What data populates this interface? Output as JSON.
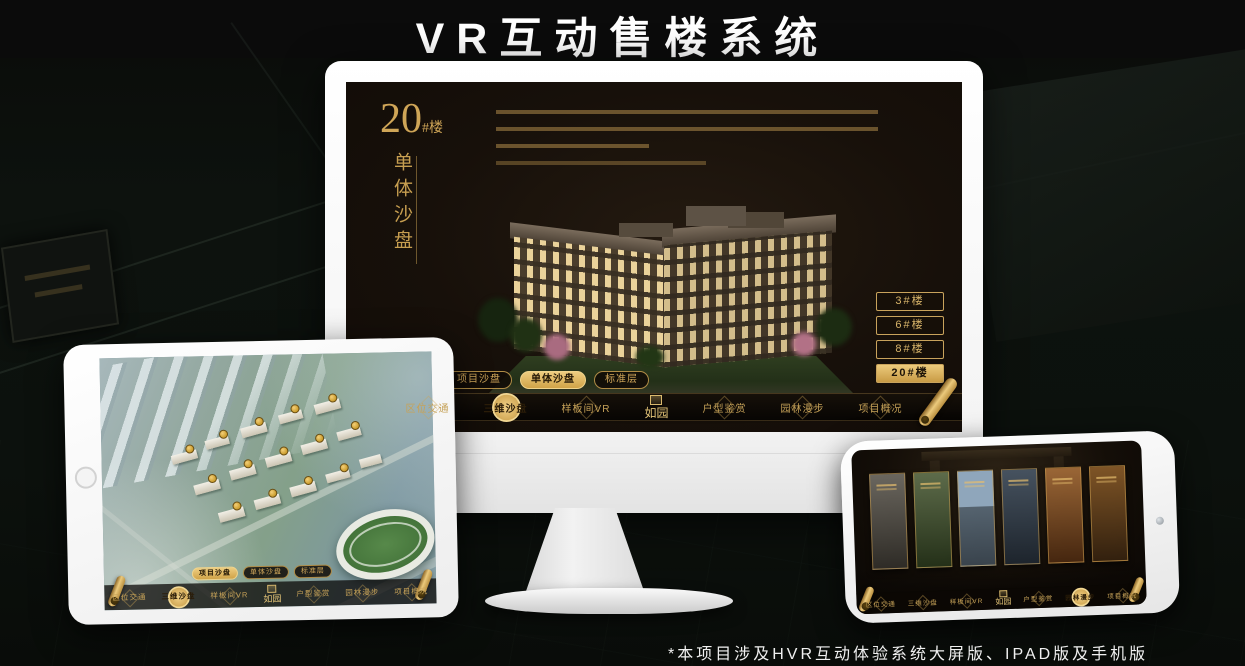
{
  "colors": {
    "accent_gold": "#d2a855",
    "active_gold": "#e2bc66",
    "screen_bg": "#17100a",
    "title_white": "#ffffff"
  },
  "page": {
    "title": "VR互动售楼系统",
    "footnote": "*本项目涉及HVR互动体验系统大屏版、IPAD版及手机版"
  },
  "monitor": {
    "block": {
      "number": "20",
      "suffix": "#楼",
      "subtitle": "单体沙盘"
    },
    "floor_buttons": [
      {
        "label": "3#楼"
      },
      {
        "label": "6#楼"
      },
      {
        "label": "8#楼"
      },
      {
        "label": "20#楼"
      }
    ],
    "tabs": [
      {
        "label": "项目沙盘"
      },
      {
        "label": "单体沙盘"
      },
      {
        "label": "标准层"
      }
    ],
    "nav": {
      "logo": "如园",
      "items": [
        {
          "label": "区位交通"
        },
        {
          "label": "三维沙盘"
        },
        {
          "label": "样板间VR"
        },
        {
          "label": "户型鉴赏"
        },
        {
          "label": "园林漫步"
        },
        {
          "label": "项目概况"
        }
      ]
    }
  },
  "tablet": {
    "tabs": [
      {
        "label": "项目沙盘"
      },
      {
        "label": "单体沙盘"
      },
      {
        "label": "标准层"
      }
    ],
    "nav": {
      "logo": "如园",
      "items": [
        {
          "label": "区位交通"
        },
        {
          "label": "三维沙盘"
        },
        {
          "label": "样板间VR"
        },
        {
          "label": "户型鉴赏"
        },
        {
          "label": "园林漫步"
        },
        {
          "label": "项目概况"
        }
      ]
    }
  },
  "phone": {
    "nav": {
      "logo": "如园",
      "items": [
        {
          "label": "区位交通"
        },
        {
          "label": "三维沙盘"
        },
        {
          "label": "样板间VR"
        },
        {
          "label": "户型鉴赏"
        },
        {
          "label": "园林漫步"
        },
        {
          "label": "项目概况"
        }
      ]
    }
  }
}
